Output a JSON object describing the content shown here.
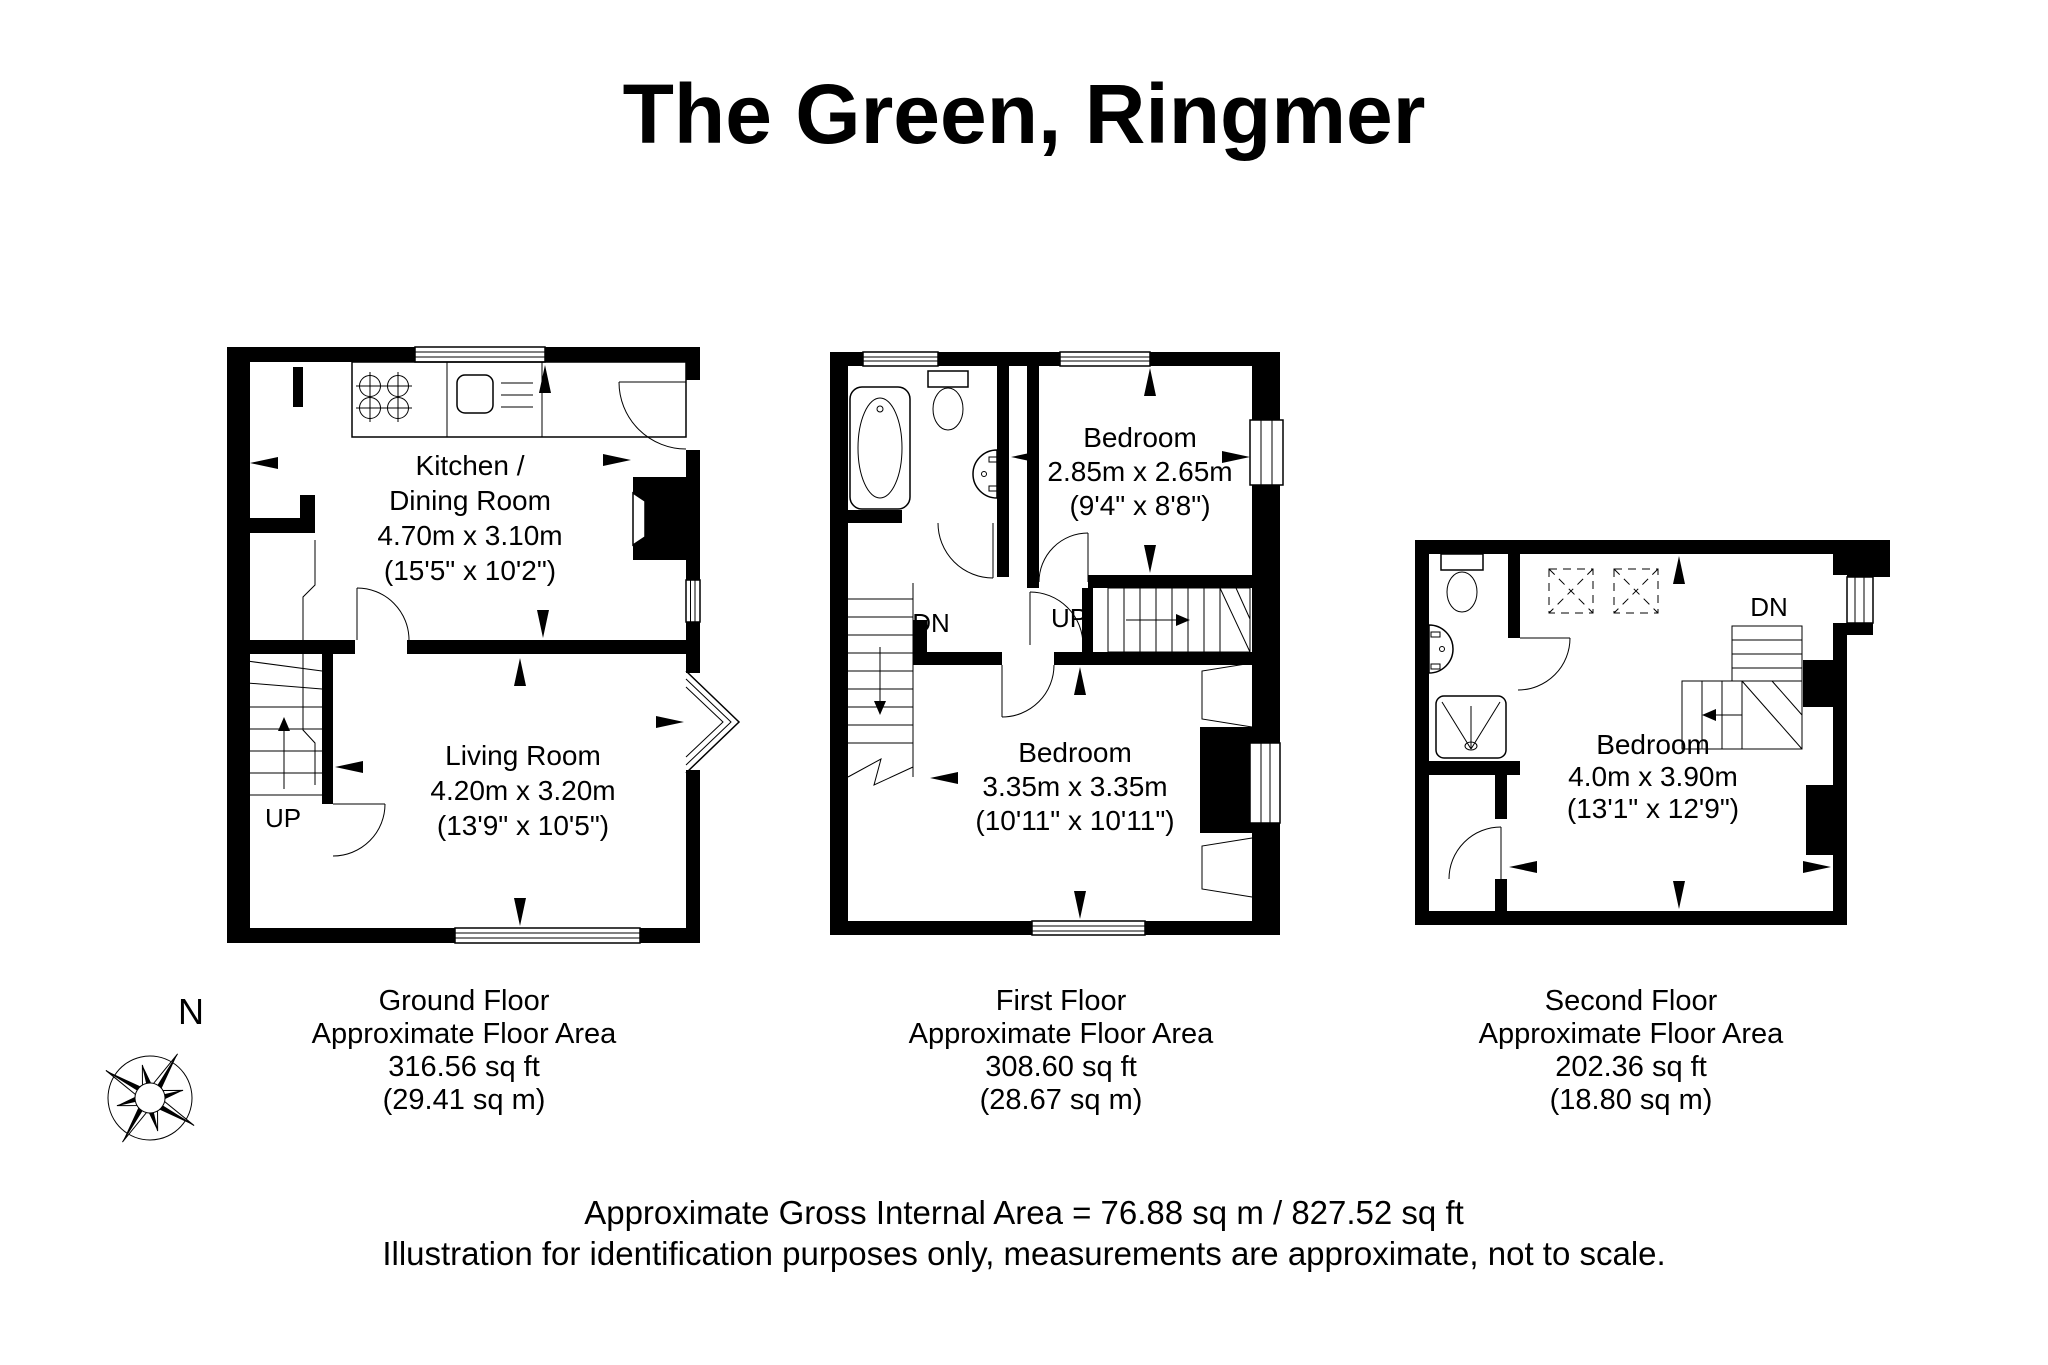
{
  "title": "The Green, Ringmer",
  "floors": {
    "ground": {
      "rooms": {
        "kitchen": [
          "Kitchen /",
          "Dining Room",
          "4.70m x 3.10m",
          "(15'5\" x 10'2\")"
        ],
        "living": [
          "Living Room",
          "4.20m x 3.20m",
          "(13'9\" x 10'5\")"
        ]
      },
      "stairs_up": "UP",
      "caption": [
        "Ground Floor",
        "Approximate Floor Area",
        "316.56 sq ft",
        "(29.41 sq m)"
      ]
    },
    "first": {
      "rooms": {
        "bedroom1": [
          "Bedroom",
          "2.85m x 2.65m",
          "(9'4\" x 8'8\")"
        ],
        "bedroom2": [
          "Bedroom",
          "3.35m x 3.35m",
          "(10'11\" x 10'11\")"
        ]
      },
      "stairs_down": "DN",
      "stairs_up": "UP",
      "caption": [
        "First Floor",
        "Approximate Floor Area",
        "308.60 sq ft",
        "(28.67 sq m)"
      ]
    },
    "second": {
      "rooms": {
        "bedroom": [
          "Bedroom",
          "4.0m x 3.90m",
          "(13'1\" x 12'9\")"
        ]
      },
      "stairs_down": "DN",
      "caption": [
        "Second Floor",
        "Approximate Floor Area",
        "202.36 sq ft",
        "(18.80 sq m)"
      ]
    }
  },
  "footer": [
    "Approximate Gross Internal Area = 76.88 sq m / 827.52 sq ft",
    "Illustration for identification purposes only, measurements are approximate, not to scale."
  ],
  "compass": {
    "north_label": "N"
  },
  "colors": {
    "wall": "#000000",
    "background": "#ffffff"
  }
}
